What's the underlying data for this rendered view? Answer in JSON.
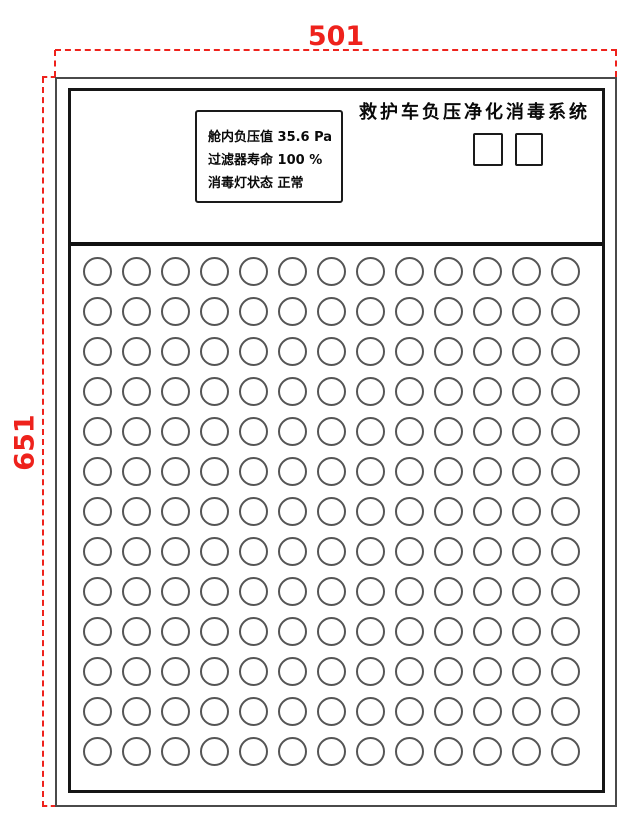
{
  "dimensions": {
    "width_label": "501",
    "height_label": "651"
  },
  "panel": {
    "title": "救护车负压净化消毒系统",
    "display": {
      "lines": [
        "舱内负压值 35.6 Pa",
        "过滤器寿命 100 %",
        "消毒灯状态 正常"
      ]
    },
    "buttons": [
      {
        "label": ""
      },
      {
        "label": ""
      }
    ],
    "grid": {
      "rows": 13,
      "cols": 13
    }
  },
  "colors": {
    "dimension_red": "#ee221c",
    "outer_frame_gray": "#4a4a4a",
    "inner_frame_black": "#161616",
    "hole_ring_gray": "#555555"
  }
}
